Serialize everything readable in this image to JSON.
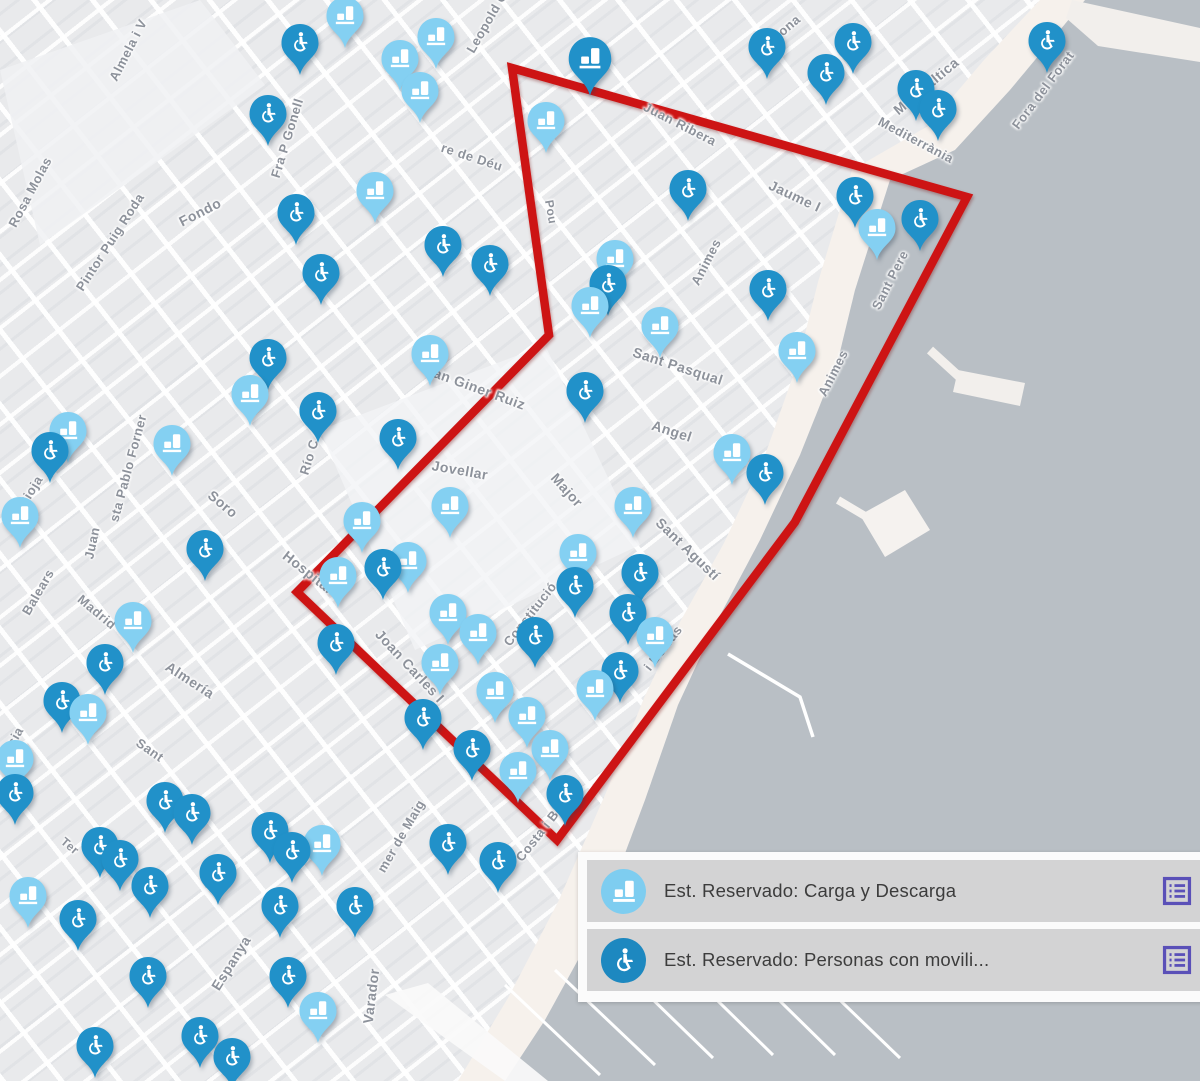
{
  "map": {
    "colors": {
      "land": "#e9eaec",
      "sea": "#b9bfc5",
      "beach": "#f6f1ec",
      "pier": "#f2efec",
      "red_zone": "#cd1414",
      "pin_light": "#84d0f2",
      "pin_dark": "#2191c9",
      "label_gray": "#8d929b",
      "legend_row_bg": "#d3d3d4",
      "action_purple": "#5a50b8"
    },
    "red_zone": {
      "points": [
        [
          512,
          68
        ],
        [
          967,
          197
        ],
        [
          795,
          522
        ],
        [
          557,
          840
        ],
        [
          297,
          592
        ],
        [
          549,
          335
        ]
      ]
    },
    "pin_types": {
      "c": {
        "name": "carga-descarga-pin",
        "icon": "truck-icon",
        "color": "#84d0f2"
      },
      "p": {
        "name": "movilidad-reducida-pin",
        "icon": "wheelchair-icon",
        "color": "#2191c9"
      },
      "x": {
        "name": "carga-descarga-cluster-pin",
        "icon": "truck-icon",
        "color": "#2191c9"
      }
    },
    "street_labels": [
      {
        "text": "Rosa Molas",
        "x": 30,
        "y": 192,
        "rot": -62,
        "fs": 13
      },
      {
        "text": "Almela i V",
        "x": 128,
        "y": 50,
        "rot": -63,
        "fs": 13
      },
      {
        "text": "Pintor Puig Roda",
        "x": 110,
        "y": 242,
        "rot": -57,
        "fs": 13
      },
      {
        "text": "Fondo",
        "x": 200,
        "y": 212,
        "rot": -27,
        "fs": 14
      },
      {
        "text": "Fra P Gonell",
        "x": 287,
        "y": 138,
        "rot": -73,
        "fs": 13
      },
      {
        "text": "Leopold Q",
        "x": 487,
        "y": 22,
        "rot": -60,
        "fs": 13
      },
      {
        "text": "rona",
        "x": 787,
        "y": 27,
        "rot": -40,
        "fs": 13
      },
      {
        "text": "Mar Bàltica",
        "x": 926,
        "y": 86,
        "rot": -40,
        "fs": 14
      },
      {
        "text": "Fora del Forat",
        "x": 1043,
        "y": 90,
        "rot": -53,
        "fs": 13
      },
      {
        "text": "Mediterrània",
        "x": 916,
        "y": 140,
        "rot": 28,
        "fs": 13
      },
      {
        "text": "Juan Ribera",
        "x": 680,
        "y": 124,
        "rot": 27,
        "fs": 13
      },
      {
        "text": "Jaume I",
        "x": 795,
        "y": 196,
        "rot": 25,
        "fs": 14
      },
      {
        "text": "Animes",
        "x": 706,
        "y": 262,
        "rot": -63,
        "fs": 13
      },
      {
        "text": "Animes",
        "x": 833,
        "y": 373,
        "rot": -63,
        "fs": 13
      },
      {
        "text": "Sant Pere",
        "x": 890,
        "y": 280,
        "rot": -63,
        "fs": 13
      },
      {
        "text": "Sant Pasqual",
        "x": 678,
        "y": 366,
        "rot": 18,
        "fs": 14
      },
      {
        "text": "Angel",
        "x": 672,
        "y": 431,
        "rot": 18,
        "fs": 14
      },
      {
        "text": "San Giner Ruiz",
        "x": 475,
        "y": 387,
        "rot": 20,
        "fs": 14
      },
      {
        "text": "re de Déu",
        "x": 472,
        "y": 157,
        "rot": 18,
        "fs": 13
      },
      {
        "text": "Pou",
        "x": 551,
        "y": 212,
        "rot": 80,
        "fs": 12
      },
      {
        "text": "Jovellar",
        "x": 460,
        "y": 470,
        "rot": 10,
        "fs": 14
      },
      {
        "text": "Major",
        "x": 567,
        "y": 490,
        "rot": 48,
        "fs": 14
      },
      {
        "text": "Sant Agustí",
        "x": 688,
        "y": 549,
        "rot": 44,
        "fs": 14
      },
      {
        "text": "i Borras",
        "x": 663,
        "y": 648,
        "rot": -52,
        "fs": 13
      },
      {
        "text": "Costa i Borras",
        "x": 548,
        "y": 822,
        "rot": -52,
        "fs": 13
      },
      {
        "text": "Constitució",
        "x": 530,
        "y": 614,
        "rot": -52,
        "fs": 13
      },
      {
        "text": "Joan Carles I",
        "x": 410,
        "y": 666,
        "rot": 47,
        "fs": 14
      },
      {
        "text": "Hospital",
        "x": 308,
        "y": 572,
        "rot": 38,
        "fs": 14
      },
      {
        "text": "Soro",
        "x": 223,
        "y": 504,
        "rot": 40,
        "fs": 14
      },
      {
        "text": "Río C",
        "x": 309,
        "y": 457,
        "rot": -73,
        "fs": 13
      },
      {
        "text": "sta Pablo Forner",
        "x": 128,
        "y": 468,
        "rot": -75,
        "fs": 13
      },
      {
        "text": "Juan",
        "x": 92,
        "y": 543,
        "rot": -78,
        "fs": 13
      },
      {
        "text": "La Rioja",
        "x": 25,
        "y": 500,
        "rot": -58,
        "fs": 13
      },
      {
        "text": "Balears",
        "x": 38,
        "y": 592,
        "rot": -60,
        "fs": 13
      },
      {
        "text": "usia",
        "x": 13,
        "y": 740,
        "rot": -60,
        "fs": 13
      },
      {
        "text": "Madrid",
        "x": 97,
        "y": 612,
        "rot": 40,
        "fs": 13
      },
      {
        "text": "Almería",
        "x": 190,
        "y": 680,
        "rot": 33,
        "fs": 14
      },
      {
        "text": "Sant",
        "x": 150,
        "y": 750,
        "rot": 35,
        "fs": 13
      },
      {
        "text": "Ter",
        "x": 70,
        "y": 846,
        "rot": 40,
        "fs": 12
      },
      {
        "text": "Espanya",
        "x": 231,
        "y": 963,
        "rot": -58,
        "fs": 14
      },
      {
        "text": "Varador",
        "x": 371,
        "y": 996,
        "rot": -83,
        "fs": 14
      },
      {
        "text": "mer de Maig",
        "x": 401,
        "y": 836,
        "rot": -60,
        "fs": 13
      }
    ],
    "pins": [
      {
        "x": 345,
        "y": 15,
        "t": "c"
      },
      {
        "x": 300,
        "y": 42,
        "t": "p"
      },
      {
        "x": 400,
        "y": 58,
        "t": "c"
      },
      {
        "x": 436,
        "y": 36,
        "t": "c"
      },
      {
        "x": 590,
        "y": 58,
        "t": "x"
      },
      {
        "x": 767,
        "y": 46,
        "t": "p"
      },
      {
        "x": 826,
        "y": 72,
        "t": "p"
      },
      {
        "x": 853,
        "y": 41,
        "t": "p"
      },
      {
        "x": 916,
        "y": 88,
        "t": "p"
      },
      {
        "x": 938,
        "y": 108,
        "t": "p"
      },
      {
        "x": 1047,
        "y": 40,
        "t": "p"
      },
      {
        "x": 268,
        "y": 113,
        "t": "p"
      },
      {
        "x": 420,
        "y": 90,
        "t": "c"
      },
      {
        "x": 546,
        "y": 120,
        "t": "c"
      },
      {
        "x": 375,
        "y": 190,
        "t": "c"
      },
      {
        "x": 296,
        "y": 212,
        "t": "p"
      },
      {
        "x": 321,
        "y": 272,
        "t": "p"
      },
      {
        "x": 443,
        "y": 244,
        "t": "p"
      },
      {
        "x": 490,
        "y": 263,
        "t": "p"
      },
      {
        "x": 688,
        "y": 188,
        "t": "p"
      },
      {
        "x": 855,
        "y": 195,
        "t": "p"
      },
      {
        "x": 877,
        "y": 227,
        "t": "c"
      },
      {
        "x": 920,
        "y": 218,
        "t": "p"
      },
      {
        "x": 615,
        "y": 258,
        "t": "c"
      },
      {
        "x": 608,
        "y": 283,
        "t": "p"
      },
      {
        "x": 590,
        "y": 305,
        "t": "c"
      },
      {
        "x": 660,
        "y": 325,
        "t": "c"
      },
      {
        "x": 768,
        "y": 288,
        "t": "p"
      },
      {
        "x": 797,
        "y": 350,
        "t": "c"
      },
      {
        "x": 268,
        "y": 357,
        "t": "p"
      },
      {
        "x": 250,
        "y": 393,
        "t": "c"
      },
      {
        "x": 318,
        "y": 410,
        "t": "p"
      },
      {
        "x": 430,
        "y": 353,
        "t": "c"
      },
      {
        "x": 585,
        "y": 390,
        "t": "p"
      },
      {
        "x": 50,
        "y": 450,
        "t": "p"
      },
      {
        "x": 68,
        "y": 430,
        "t": "c"
      },
      {
        "x": 172,
        "y": 443,
        "t": "c"
      },
      {
        "x": 398,
        "y": 437,
        "t": "p"
      },
      {
        "x": 732,
        "y": 452,
        "t": "c"
      },
      {
        "x": 765,
        "y": 472,
        "t": "p"
      },
      {
        "x": 20,
        "y": 515,
        "t": "c"
      },
      {
        "x": 205,
        "y": 548,
        "t": "p"
      },
      {
        "x": 450,
        "y": 505,
        "t": "c"
      },
      {
        "x": 362,
        "y": 520,
        "t": "c"
      },
      {
        "x": 338,
        "y": 575,
        "t": "c"
      },
      {
        "x": 383,
        "y": 567,
        "t": "p"
      },
      {
        "x": 408,
        "y": 560,
        "t": "c"
      },
      {
        "x": 578,
        "y": 552,
        "t": "c"
      },
      {
        "x": 575,
        "y": 585,
        "t": "p"
      },
      {
        "x": 633,
        "y": 505,
        "t": "c"
      },
      {
        "x": 640,
        "y": 572,
        "t": "p"
      },
      {
        "x": 448,
        "y": 612,
        "t": "c"
      },
      {
        "x": 478,
        "y": 632,
        "t": "c"
      },
      {
        "x": 440,
        "y": 662,
        "t": "c"
      },
      {
        "x": 495,
        "y": 690,
        "t": "c"
      },
      {
        "x": 527,
        "y": 715,
        "t": "c"
      },
      {
        "x": 550,
        "y": 748,
        "t": "c"
      },
      {
        "x": 518,
        "y": 770,
        "t": "c"
      },
      {
        "x": 565,
        "y": 793,
        "t": "p"
      },
      {
        "x": 423,
        "y": 717,
        "t": "p"
      },
      {
        "x": 472,
        "y": 748,
        "t": "p"
      },
      {
        "x": 336,
        "y": 642,
        "t": "p"
      },
      {
        "x": 535,
        "y": 635,
        "t": "p"
      },
      {
        "x": 620,
        "y": 670,
        "t": "p"
      },
      {
        "x": 595,
        "y": 688,
        "t": "c"
      },
      {
        "x": 628,
        "y": 612,
        "t": "p"
      },
      {
        "x": 655,
        "y": 635,
        "t": "c"
      },
      {
        "x": 133,
        "y": 620,
        "t": "c"
      },
      {
        "x": 105,
        "y": 662,
        "t": "p"
      },
      {
        "x": 62,
        "y": 700,
        "t": "p"
      },
      {
        "x": 88,
        "y": 712,
        "t": "c"
      },
      {
        "x": 15,
        "y": 758,
        "t": "c"
      },
      {
        "x": 15,
        "y": 792,
        "t": "p"
      },
      {
        "x": 100,
        "y": 845,
        "t": "p"
      },
      {
        "x": 120,
        "y": 858,
        "t": "p"
      },
      {
        "x": 165,
        "y": 800,
        "t": "p"
      },
      {
        "x": 192,
        "y": 812,
        "t": "p"
      },
      {
        "x": 28,
        "y": 895,
        "t": "c"
      },
      {
        "x": 78,
        "y": 918,
        "t": "p"
      },
      {
        "x": 150,
        "y": 885,
        "t": "p"
      },
      {
        "x": 148,
        "y": 975,
        "t": "p"
      },
      {
        "x": 270,
        "y": 830,
        "t": "p"
      },
      {
        "x": 292,
        "y": 850,
        "t": "p"
      },
      {
        "x": 280,
        "y": 905,
        "t": "p"
      },
      {
        "x": 322,
        "y": 843,
        "t": "c"
      },
      {
        "x": 355,
        "y": 905,
        "t": "p"
      },
      {
        "x": 288,
        "y": 975,
        "t": "p"
      },
      {
        "x": 318,
        "y": 1010,
        "t": "c"
      },
      {
        "x": 200,
        "y": 1035,
        "t": "p"
      },
      {
        "x": 232,
        "y": 1056,
        "t": "p"
      },
      {
        "x": 95,
        "y": 1045,
        "t": "p"
      },
      {
        "x": 448,
        "y": 842,
        "t": "p"
      },
      {
        "x": 498,
        "y": 860,
        "t": "p"
      },
      {
        "x": 218,
        "y": 872,
        "t": "p"
      }
    ]
  },
  "legend": {
    "items": [
      {
        "icon": "truck-icon",
        "icon_color": "#7ecdf0",
        "label": "Est. Reservado: Carga y Descarga",
        "action_icon": "list-icon"
      },
      {
        "icon": "wheelchair-icon",
        "icon_color": "#1d88c0",
        "label": "Est. Reservado: Personas con movili...",
        "action_icon": "list-icon"
      }
    ]
  }
}
